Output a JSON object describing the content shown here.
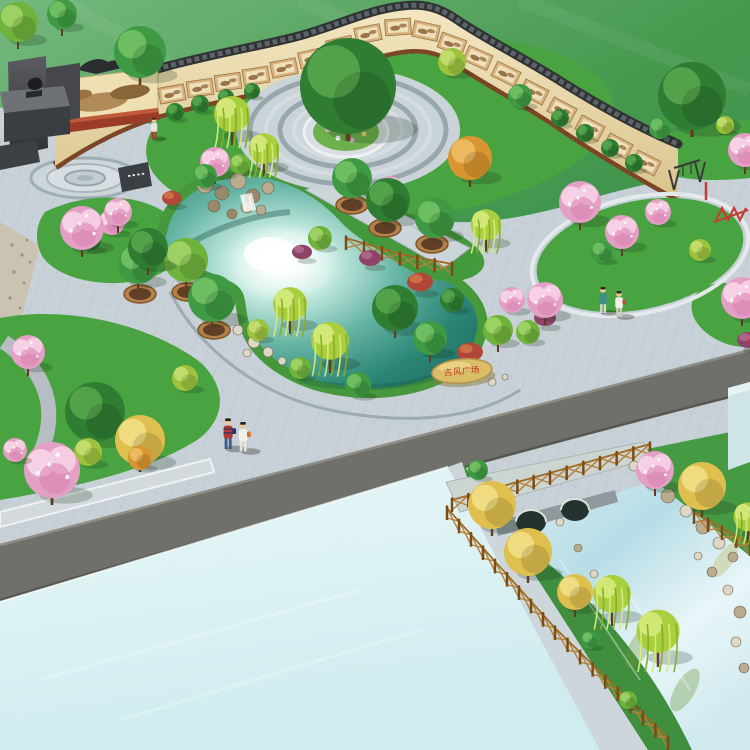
{
  "scene": {
    "description": "birdseye-landscape-render-of-cultural-plaza-park",
    "stone": {
      "text": "古风广场",
      "text_color": "#c0321c",
      "rock_color": "#d9bd66",
      "rock_shade": "#b3924a"
    },
    "palette": {
      "field_light": "#74b87e",
      "field": "#46994f",
      "field_dark": "#2e8443",
      "plaza": "#c7d1d7",
      "plaza_joint": "#aeb9c0",
      "ring_dark": "#98a6ae",
      "wall_face": "#efe2b8",
      "wall_shade": "#d9c48e",
      "coping": "#2f3335",
      "coping_hi": "#5d6366",
      "mulch": "#7c4526",
      "red_planter": "#9a3c28",
      "grass": "#4aa341",
      "grass_dark": "#3f8f3f",
      "grass_light": "#7cc84a",
      "pond_deep": "#1d6a5e",
      "pond_light": "#cdeee6",
      "lake": "#ddf2f4",
      "road": "#70706a",
      "walkway": "#ccd6db",
      "bridge_stone": "#aeb6ba",
      "bridge_face": "#8f999e",
      "fence_post": "#7a4d16",
      "fence_rail": "#a06c24",
      "fence_brace": "#b5813a",
      "planter_rim": "#b5814a",
      "planter_soil": "#5f4026",
      "rock_a": "#b9ab8d",
      "rock_b": "#99896c",
      "stone_white": "#ded7c6",
      "monument": "#3a3d42",
      "monument_light": "#6e7176",
      "panel_frame": "#d7b27c",
      "panel_paper": "#efe0bc",
      "panel_art": "#8a6034",
      "equipment_dark": "#3a3a3a",
      "equipment_red": "#c23f35"
    },
    "tree_colors": {
      "g1": {
        "base": "#2f7d33",
        "hl": "#58a84e"
      },
      "g2": {
        "base": "#3f9a43",
        "hl": "#74c465"
      },
      "g3": {
        "base": "#6fb33c",
        "hl": "#a4d66a"
      },
      "yg": {
        "base": "#9cc23e",
        "hl": "#c8e172"
      },
      "yellow": {
        "base": "#dfbf4e",
        "hl": "#f3e08a"
      },
      "orange": {
        "base": "#d9952f",
        "hl": "#eec067"
      },
      "blossom": {
        "base": "#e49fc4",
        "hl": "#f6d0e4"
      },
      "purple": {
        "base": "#8e4468",
        "hl": "#b26b8d"
      },
      "red": {
        "base": "#b0483a",
        "hl": "#d4764a"
      },
      "willow": {
        "base": "#a9cf3f",
        "hl": "#d6ea7c",
        "strand": "#86ad25"
      }
    },
    "wall": {
      "panels": [
        [
          172,
          94,
          -10
        ],
        [
          200,
          88,
          -8
        ],
        [
          228,
          82,
          -8
        ],
        [
          256,
          76,
          -9
        ],
        [
          284,
          68,
          -11
        ],
        [
          312,
          58,
          -13
        ],
        [
          340,
          46,
          -13
        ],
        [
          368,
          34,
          -11
        ],
        [
          398,
          27,
          -4
        ],
        [
          426,
          31,
          12
        ],
        [
          452,
          44,
          20
        ],
        [
          478,
          58,
          24
        ],
        [
          506,
          74,
          26
        ],
        [
          534,
          92,
          27
        ],
        [
          562,
          110,
          28
        ],
        [
          590,
          128,
          28
        ],
        [
          618,
          146,
          28
        ],
        [
          646,
          163,
          27
        ]
      ]
    },
    "back_trees": [
      [
        18,
        22,
        20,
        "r",
        "g3"
      ],
      [
        62,
        14,
        15,
        "r",
        "g2"
      ]
    ],
    "trees": [
      [
        175,
        112,
        9,
        "b",
        "g1"
      ],
      [
        200,
        104,
        9,
        "b",
        "g1"
      ],
      [
        226,
        97,
        8,
        "b",
        "g1"
      ],
      [
        252,
        91,
        8,
        "b",
        "g1"
      ],
      [
        560,
        118,
        9,
        "b",
        "g1"
      ],
      [
        585,
        133,
        9,
        "b",
        "g1"
      ],
      [
        610,
        148,
        9,
        "b",
        "g1"
      ],
      [
        634,
        163,
        9,
        "b",
        "g1"
      ],
      [
        452,
        62,
        14,
        "b",
        "yg"
      ],
      [
        520,
        96,
        12,
        "b",
        "g2"
      ],
      [
        232,
        118,
        20,
        "w",
        "willow"
      ],
      [
        264,
        152,
        17,
        "w",
        "willow"
      ],
      [
        215,
        162,
        15,
        "p",
        "blossom"
      ],
      [
        390,
        188,
        12,
        "p",
        "blossom"
      ],
      [
        470,
        158,
        22,
        "r",
        "orange"
      ],
      [
        140,
        52,
        26,
        "r",
        "g2"
      ],
      [
        348,
        86,
        48,
        "r",
        "g1"
      ],
      [
        352,
        178,
        20,
        "r",
        "g2"
      ],
      [
        388,
        200,
        22,
        "r",
        "g1"
      ],
      [
        435,
        218,
        20,
        "r",
        "g2"
      ],
      [
        486,
        228,
        17,
        "w",
        "willow"
      ],
      [
        205,
        176,
        12,
        "b",
        "g2"
      ],
      [
        240,
        164,
        10,
        "b",
        "g3"
      ],
      [
        172,
        198,
        10,
        "s",
        "red"
      ],
      [
        112,
        222,
        13,
        "p",
        "blossom"
      ],
      [
        90,
        240,
        11,
        "b",
        "g1"
      ],
      [
        320,
        238,
        12,
        "b",
        "g3"
      ],
      [
        302,
        252,
        10,
        "s",
        "purple"
      ],
      [
        370,
        258,
        11,
        "s",
        "purple"
      ],
      [
        420,
        282,
        13,
        "s",
        "red"
      ],
      [
        452,
        300,
        12,
        "b",
        "g1"
      ],
      [
        138,
        264,
        20,
        "r",
        "g2"
      ],
      [
        186,
        260,
        22,
        "r",
        "g3"
      ],
      [
        212,
        298,
        24,
        "r",
        "g2"
      ],
      [
        82,
        228,
        22,
        "p",
        "blossom"
      ],
      [
        118,
        212,
        14,
        "p",
        "blossom"
      ],
      [
        148,
        248,
        20,
        "r",
        "g1"
      ],
      [
        290,
        308,
        19,
        "w",
        "willow"
      ],
      [
        330,
        345,
        21,
        "w",
        "willow"
      ],
      [
        258,
        330,
        11,
        "b",
        "yg"
      ],
      [
        300,
        368,
        11,
        "b",
        "g3"
      ],
      [
        358,
        385,
        13,
        "b",
        "g2"
      ],
      [
        395,
        308,
        23,
        "r",
        "g1"
      ],
      [
        430,
        338,
        17,
        "r",
        "g2"
      ],
      [
        470,
        352,
        13,
        "s",
        "red"
      ],
      [
        498,
        330,
        15,
        "r",
        "g3"
      ],
      [
        512,
        300,
        13,
        "p",
        "blossom"
      ],
      [
        545,
        318,
        11,
        "s",
        "purple"
      ],
      [
        28,
        352,
        17,
        "p",
        "blossom"
      ],
      [
        95,
        412,
        30,
        "r",
        "g1"
      ],
      [
        140,
        440,
        25,
        "r",
        "yellow"
      ],
      [
        88,
        452,
        14,
        "b",
        "yg"
      ],
      [
        185,
        378,
        13,
        "b",
        "yg"
      ],
      [
        52,
        470,
        28,
        "p",
        "blossom"
      ],
      [
        140,
        458,
        12,
        "b",
        "orange"
      ],
      [
        15,
        450,
        12,
        "p",
        "blossom"
      ],
      [
        580,
        202,
        21,
        "p",
        "blossom"
      ],
      [
        622,
        232,
        17,
        "p",
        "blossom"
      ],
      [
        658,
        212,
        13,
        "p",
        "blossom"
      ],
      [
        602,
        252,
        11,
        "b",
        "g2"
      ],
      [
        700,
        250,
        11,
        "b",
        "yg"
      ],
      [
        545,
        300,
        18,
        "p",
        "blossom"
      ],
      [
        528,
        332,
        12,
        "b",
        "g3"
      ],
      [
        742,
        298,
        21,
        "p",
        "blossom"
      ],
      [
        748,
        340,
        11,
        "s",
        "purple"
      ],
      [
        692,
        96,
        34,
        "r",
        "g1"
      ],
      [
        745,
        150,
        17,
        "p",
        "blossom"
      ],
      [
        660,
        128,
        11,
        "b",
        "g2"
      ],
      [
        725,
        125,
        9,
        "b",
        "yg"
      ],
      [
        478,
        470,
        10,
        "b",
        "g2"
      ],
      [
        492,
        505,
        24,
        "r",
        "yellow"
      ],
      [
        528,
        552,
        24,
        "r",
        "yellow"
      ],
      [
        575,
        592,
        18,
        "r",
        "yellow"
      ],
      [
        655,
        470,
        19,
        "p",
        "blossom"
      ],
      [
        702,
        486,
        24,
        "r",
        "yellow"
      ],
      [
        748,
        520,
        16,
        "w",
        "willow"
      ],
      [
        612,
        598,
        21,
        "w",
        "willow"
      ],
      [
        658,
        636,
        24,
        "w",
        "willow"
      ],
      [
        628,
        700,
        9,
        "b",
        "g3"
      ],
      [
        590,
        640,
        9,
        "b",
        "g2"
      ]
    ],
    "planters": [
      [
        140,
        294
      ],
      [
        188,
        292
      ],
      [
        214,
        330
      ],
      [
        352,
        205
      ],
      [
        385,
        228
      ],
      [
        432,
        244
      ]
    ],
    "fences": [
      [
        [
          346,
          250
        ],
        [
          400,
          266
        ],
        [
          452,
          276
        ]
      ],
      [
        [
          452,
          512
        ],
        [
          550,
          485
        ],
        [
          650,
          456
        ]
      ],
      [
        [
          447,
          520
        ],
        [
          555,
          640
        ],
        [
          668,
          750
        ]
      ],
      [
        [
          694,
          524
        ],
        [
          750,
          556
        ]
      ]
    ],
    "people": [
      {
        "x": 228,
        "y": 436,
        "h": 26,
        "shirt": "#b23939",
        "stripes": "#28365e",
        "pants": "#3c5a8c",
        "bag": "#28365e"
      },
      {
        "x": 243,
        "y": 439,
        "h": 25,
        "shirt": "#f0efe9",
        "pants": "#e8e4da",
        "bag": "#e06a28"
      },
      {
        "x": 603,
        "y": 302,
        "h": 22,
        "shirt": "#3d8f86",
        "pants": "#d8d8d0"
      },
      {
        "x": 619,
        "y": 306,
        "h": 22,
        "shirt": "#efeee8",
        "pants": "#cfcabe",
        "bag": "#cc4444"
      },
      {
        "x": 154,
        "y": 130,
        "h": 18,
        "shirt": "#e8e6df",
        "pants": "#bb3333"
      }
    ],
    "rocks": {
      "rockery": [
        [
          205,
          185,
          8
        ],
        [
          222,
          193,
          7
        ],
        [
          238,
          181,
          8
        ],
        [
          253,
          196,
          7
        ],
        [
          268,
          188,
          6
        ],
        [
          214,
          206,
          6
        ],
        [
          247,
          207,
          6
        ],
        [
          232,
          214,
          5
        ],
        [
          261,
          210,
          5
        ]
      ],
      "pond_stones": [
        [
          238,
          330,
          5
        ],
        [
          254,
          342,
          6
        ],
        [
          268,
          352,
          5
        ],
        [
          247,
          353,
          4
        ],
        [
          282,
          361,
          4
        ],
        [
          492,
          382,
          4
        ],
        [
          505,
          377,
          3
        ]
      ],
      "canal": [
        [
          650,
          482,
          6
        ],
        [
          668,
          496,
          7
        ],
        [
          686,
          511,
          6
        ],
        [
          703,
          527,
          7
        ],
        [
          719,
          543,
          6
        ],
        [
          733,
          557,
          5
        ],
        [
          698,
          556,
          4
        ],
        [
          660,
          470,
          4
        ],
        [
          634,
          466,
          5
        ],
        [
          712,
          572,
          5
        ],
        [
          728,
          590,
          5
        ],
        [
          740,
          612,
          6
        ],
        [
          736,
          642,
          5
        ],
        [
          744,
          668,
          5
        ],
        [
          560,
          522,
          4
        ],
        [
          578,
          548,
          4
        ],
        [
          594,
          574,
          4
        ]
      ]
    }
  }
}
